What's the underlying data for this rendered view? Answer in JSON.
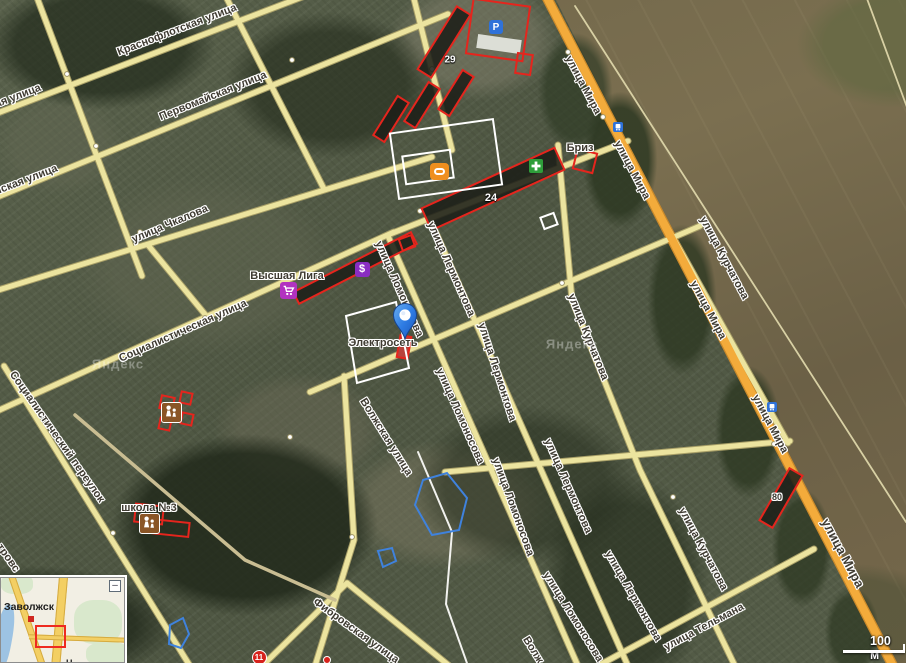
{
  "app": "satellite-map-view",
  "town": "Заволжск",
  "colors": {
    "building_outline": "#e5251d",
    "road": "#ece49f",
    "main_road": "#f3ab3b",
    "selection_blue": "#3f82dd",
    "pin_blue": "#2f7de0",
    "poi_purple": "#b232c0",
    "poi_violet": "#8a2dc2",
    "poi_green": "#2e9e3a",
    "poi_blue": "#2f72d9",
    "poi_brown": "#8a5526",
    "stadium_orange": "#ef8f1f"
  },
  "street_labels": [
    {
      "t": "Краснофлотская улица",
      "x": 177,
      "y": 30,
      "r": -21,
      "s": 11
    },
    {
      "t": "ая улица",
      "x": 18,
      "y": 96,
      "r": -21,
      "s": 11
    },
    {
      "t": "Первомайская улица",
      "x": 213,
      "y": 96,
      "r": -22,
      "s": 11
    },
    {
      "t": "йская улица",
      "x": 26,
      "y": 180,
      "r": -21,
      "s": 11
    },
    {
      "t": "улица Чкалова",
      "x": 170,
      "y": 224,
      "r": -23,
      "s": 11
    },
    {
      "t": "Социалистическая улица",
      "x": 183,
      "y": 331,
      "r": -24,
      "s": 11
    },
    {
      "t": "Социалистический переулок",
      "x": 57,
      "y": 437,
      "r": 55,
      "s": 11
    },
    {
      "t": "тровс",
      "x": 8,
      "y": 558,
      "r": 55,
      "s": 11
    },
    {
      "t": "улица Мира",
      "x": 583,
      "y": 85,
      "r": 62,
      "s": 11
    },
    {
      "t": "улица Мира",
      "x": 632,
      "y": 170,
      "r": 62,
      "s": 11
    },
    {
      "t": "улица Мира",
      "x": 708,
      "y": 310,
      "r": 62,
      "s": 11
    },
    {
      "t": "улица Мира",
      "x": 770,
      "y": 424,
      "r": 62,
      "s": 11
    },
    {
      "t": "улица Мира",
      "x": 843,
      "y": 553,
      "r": 62,
      "s": 13
    },
    {
      "t": "улица Лермонтова",
      "x": 451,
      "y": 269,
      "r": 66,
      "s": 11
    },
    {
      "t": "улица Лермонтова",
      "x": 497,
      "y": 372,
      "r": 72,
      "s": 11
    },
    {
      "t": "улица Лермонтова",
      "x": 568,
      "y": 486,
      "r": 66,
      "s": 11
    },
    {
      "t": "улица Лермонтова",
      "x": 633,
      "y": 596,
      "r": 60,
      "s": 11
    },
    {
      "t": "улица Ломоносова",
      "x": 399,
      "y": 289,
      "r": 66,
      "s": 11
    },
    {
      "t": "улица Ломоносова",
      "x": 460,
      "y": 416,
      "r": 66,
      "s": 11
    },
    {
      "t": "улица Ломоносова",
      "x": 513,
      "y": 507,
      "r": 70,
      "s": 11
    },
    {
      "t": "улица Ломоносова",
      "x": 573,
      "y": 617,
      "r": 58,
      "s": 11
    },
    {
      "t": "улица Курчатова",
      "x": 588,
      "y": 337,
      "r": 68,
      "s": 11
    },
    {
      "t": "улица Курчатова",
      "x": 724,
      "y": 258,
      "r": 62,
      "s": 11
    },
    {
      "t": "улица Курчатова",
      "x": 703,
      "y": 549,
      "r": 62,
      "s": 11
    },
    {
      "t": "улица Тельмана",
      "x": 704,
      "y": 627,
      "r": -28,
      "s": 11
    },
    {
      "t": "Волжская улица",
      "x": 386,
      "y": 437,
      "r": 58,
      "s": 11
    },
    {
      "t": "Волж",
      "x": 533,
      "y": 650,
      "r": 58,
      "s": 11
    },
    {
      "t": "Фибровская улица",
      "x": 356,
      "y": 631,
      "r": 36,
      "s": 11
    }
  ],
  "poi_labels": [
    {
      "t": "Высшая Лига",
      "x": 287,
      "y": 276
    },
    {
      "t": "Электросеть",
      "x": 383,
      "y": 343
    },
    {
      "t": "Бриз",
      "x": 580,
      "y": 148
    },
    {
      "t": "школа №3",
      "x": 149,
      "y": 508
    }
  ],
  "building_labels": [
    {
      "t": "29",
      "x": 450,
      "y": 60,
      "style": "white",
      "s": 10
    },
    {
      "t": "24",
      "x": 491,
      "y": 198,
      "style": "white",
      "s": 11
    },
    {
      "t": "80",
      "x": 777,
      "y": 497,
      "style": "halo",
      "s": 9
    }
  ],
  "icons": [
    {
      "type": "parking",
      "name": "parking-icon",
      "x": 496,
      "y": 27
    },
    {
      "type": "stadium",
      "name": "stadium-icon",
      "x": 439,
      "y": 171
    },
    {
      "type": "pharmacy",
      "name": "pharmacy-cross-icon",
      "x": 536,
      "y": 166
    },
    {
      "type": "bus",
      "name": "bus-stop-icon",
      "x": 618,
      "y": 127
    },
    {
      "type": "bus",
      "name": "bus-stop-icon",
      "x": 772,
      "y": 407
    },
    {
      "type": "cart",
      "name": "shopping-cart-icon",
      "x": 288,
      "y": 290
    },
    {
      "type": "dollar",
      "name": "currency-exchange-icon",
      "x": 362,
      "y": 269
    },
    {
      "type": "kids",
      "name": "kindergarten-icon",
      "x": 171,
      "y": 412
    },
    {
      "type": "kids",
      "name": "school-icon",
      "x": 149,
      "y": 523
    },
    {
      "type": "badge11",
      "name": "building-badge-11",
      "x": 259,
      "y": 657,
      "label": "11"
    },
    {
      "type": "reddot",
      "name": "red-poi-dot",
      "x": 327,
      "y": 660
    },
    {
      "type": "pin",
      "name": "location-pin",
      "x": 405,
      "y": 339
    }
  ],
  "parking_label": "P",
  "dollar_label": "$",
  "watermark": {
    "text": "Яндекс",
    "positions": [
      {
        "x": 572,
        "y": 344
      },
      {
        "x": 118,
        "y": 364
      }
    ]
  },
  "minimap": {
    "town_label": "Заволжск",
    "partial_town_label": "Н",
    "collapse_label": "–"
  },
  "scale_bar": {
    "label": "100 м"
  }
}
